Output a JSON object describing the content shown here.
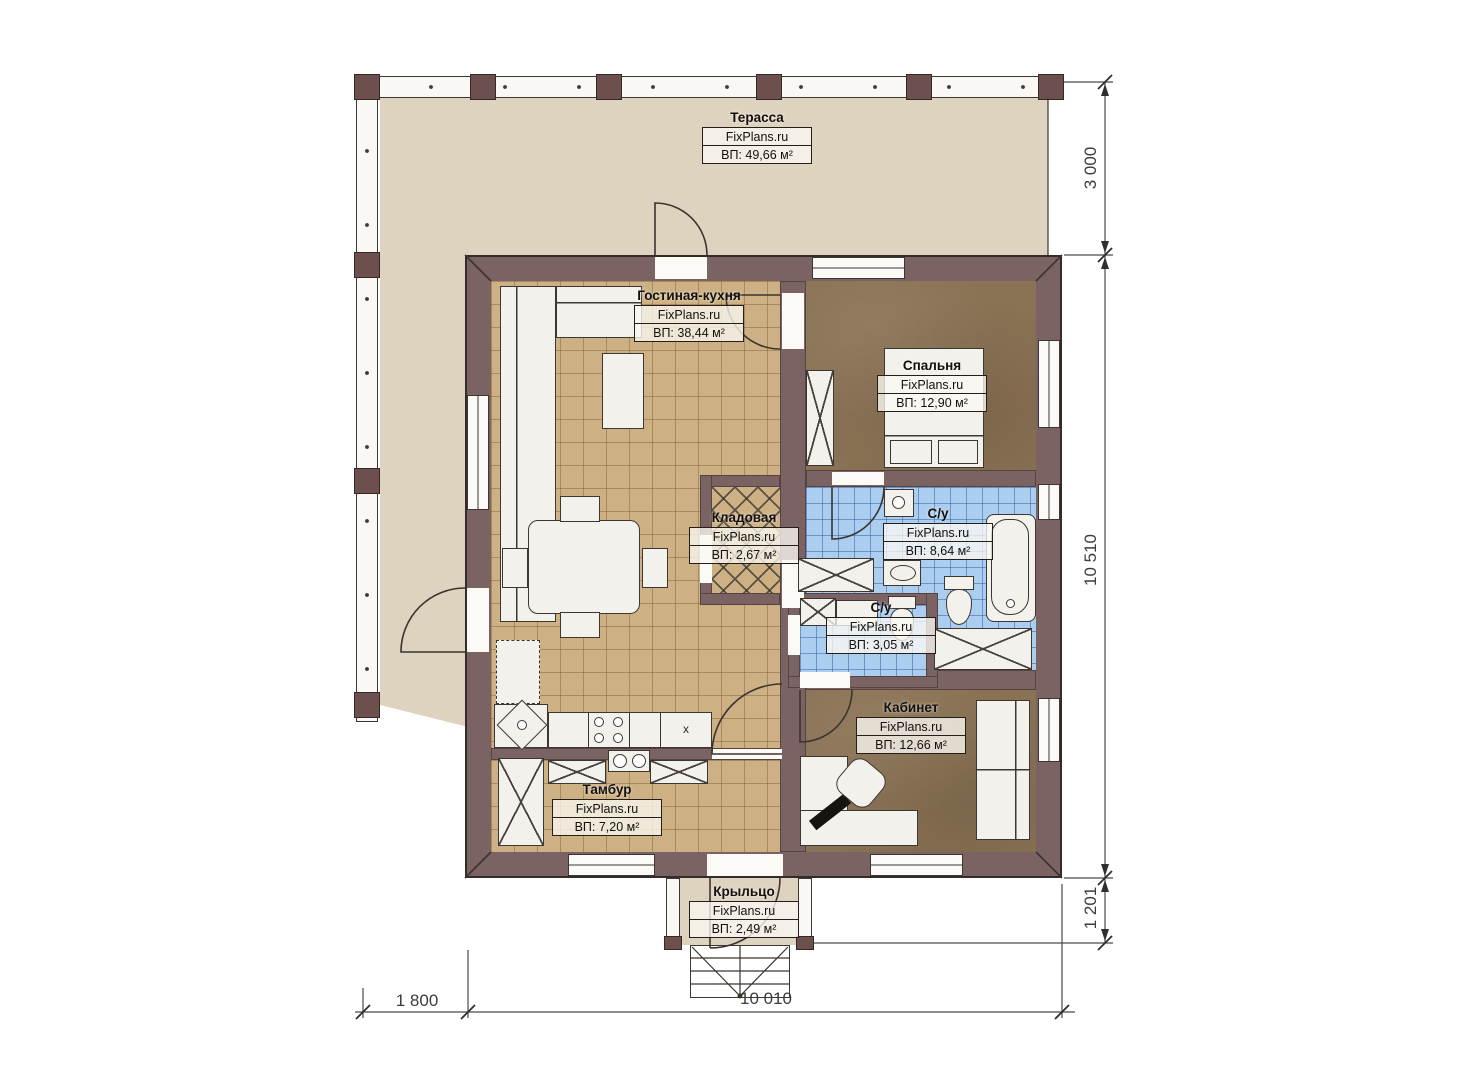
{
  "plan": {
    "brand": "FixPlans.ru",
    "rooms": [
      {
        "name": "Терасса",
        "area": "ВП: 49,66 м²"
      },
      {
        "name": "Гостиная-кухня",
        "area": "ВП: 38,44 м²"
      },
      {
        "name": "Спальня",
        "area": "ВП: 12,90 м²"
      },
      {
        "name": "Кладовая",
        "area": "ВП: 2,67 м²"
      },
      {
        "name": "С/у",
        "area": "ВП: 8,64 м²"
      },
      {
        "name": "С/у",
        "area": "ВП: 3,05 м²"
      },
      {
        "name": "Кабинет",
        "area": "ВП: 12,66 м²"
      },
      {
        "name": "Тамбур",
        "area": "ВП: 7,20 м²"
      },
      {
        "name": "Крыльцо",
        "area": "ВП: 2,49 м²"
      }
    ],
    "dimensions": {
      "terrace_depth": "3 000",
      "house_height": "10 510",
      "porch_depth": "1 201",
      "terrace_width": "1 800",
      "house_width": "10 010"
    },
    "markers": {
      "kitchen_cabinet": "x"
    },
    "colors": {
      "wall": "#7b6263",
      "terrace_floor": "#ded3bf",
      "tile_floor": "#cdb184",
      "wood_floor": "#8a7254",
      "bath_floor": "#abcdf0"
    }
  }
}
